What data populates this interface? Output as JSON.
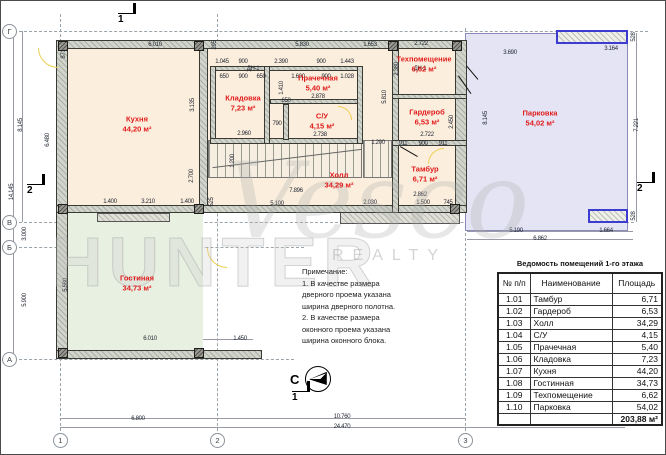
{
  "watermark": {
    "script": "Vesco",
    "caps": "REALTY",
    "outline": "HUNTER"
  },
  "plan": {
    "compass_label": "С",
    "rooms": [
      {
        "name": "Кухня",
        "area": "44,20 м²",
        "x": 137,
        "y": 124
      },
      {
        "name": "Кладовка",
        "area": "7,23 м²",
        "x": 243,
        "y": 103
      },
      {
        "name": "Прачечная",
        "area": "5,40 м²",
        "x": 318,
        "y": 83
      },
      {
        "name": "С/У",
        "area": "4,15 м²",
        "x": 322,
        "y": 121
      },
      {
        "name": "Гардероб",
        "area": "6,53 м²",
        "x": 427,
        "y": 117
      },
      {
        "name": "Техпомещение",
        "area": "6,62 м²",
        "x": 424,
        "y": 64
      },
      {
        "name": "Тамбур",
        "area": "6,71 м²",
        "x": 425,
        "y": 174
      },
      {
        "name": "Холл",
        "area": "34,29 м²",
        "x": 339,
        "y": 180
      },
      {
        "name": "Парковка",
        "area": "54,02 м²",
        "x": 540,
        "y": 118
      },
      {
        "name": "Гостиная",
        "area": "34,73 м²",
        "x": 137,
        "y": 283
      }
    ],
    "axis_bubbles_left": [
      {
        "label": "Г",
        "y": 31
      },
      {
        "label": "В",
        "y": 222
      },
      {
        "label": "Б",
        "y": 247
      },
      {
        "label": "А",
        "y": 359
      }
    ],
    "axis_bubbles_bottom": [
      {
        "label": "1",
        "x": 60
      },
      {
        "label": "2",
        "x": 217
      },
      {
        "label": "3",
        "x": 465
      }
    ],
    "section_markers": [
      {
        "label": "1",
        "x": 118,
        "y": 3
      },
      {
        "label": "1",
        "x": 292,
        "y": 381
      },
      {
        "label": "2",
        "x": 27,
        "y": 174
      },
      {
        "label": "2",
        "x": 637,
        "y": 172
      }
    ],
    "dim_labels": [
      {
        "t": "6.010",
        "x": 155,
        "y": 45
      },
      {
        "t": "295",
        "x": 215,
        "y": 45,
        "r": 1
      },
      {
        "t": "5.830",
        "x": 302,
        "y": 45
      },
      {
        "t": "1.653",
        "x": 370,
        "y": 45
      },
      {
        "t": "2.722",
        "x": 421,
        "y": 44
      },
      {
        "t": "3.690",
        "x": 510,
        "y": 53
      },
      {
        "t": "3.164",
        "x": 611,
        "y": 49
      },
      {
        "t": "528",
        "x": 634,
        "y": 37,
        "r": 1
      },
      {
        "t": "528",
        "x": 634,
        "y": 216,
        "r": 1
      },
      {
        "t": "1.045",
        "x": 222,
        "y": 62
      },
      {
        "t": "900",
        "x": 243,
        "y": 62
      },
      {
        "t": "2.390",
        "x": 281,
        "y": 62
      },
      {
        "t": "900",
        "x": 321,
        "y": 62
      },
      {
        "t": "1.443",
        "x": 347,
        "y": 62
      },
      {
        "t": "ДН-1",
        "x": 253,
        "y": 69
      },
      {
        "t": "ДН-1",
        "x": 420,
        "y": 69
      },
      {
        "t": "650",
        "x": 224,
        "y": 77
      },
      {
        "t": "900",
        "x": 243,
        "y": 77
      },
      {
        "t": "650",
        "x": 261,
        "y": 77
      },
      {
        "t": "1.600",
        "x": 298,
        "y": 77
      },
      {
        "t": "900",
        "x": 326,
        "y": 77
      },
      {
        "t": "1.028",
        "x": 347,
        "y": 77
      },
      {
        "t": "871",
        "x": 64,
        "y": 54,
        "r": 1
      },
      {
        "t": "8.145",
        "x": 21,
        "y": 125,
        "r": 1
      },
      {
        "t": "14.145",
        "x": 12,
        "y": 192,
        "r": 1
      },
      {
        "t": "6.480",
        "x": 48,
        "y": 140,
        "r": 1
      },
      {
        "t": "3.000",
        "x": 25,
        "y": 234,
        "r": 1
      },
      {
        "t": "5.900",
        "x": 25,
        "y": 300,
        "r": 1
      },
      {
        "t": "5.580",
        "x": 66,
        "y": 285,
        "r": 1
      },
      {
        "t": "3.135",
        "x": 193,
        "y": 105,
        "r": 1
      },
      {
        "t": "2.700",
        "x": 192,
        "y": 176,
        "r": 1
      },
      {
        "t": "1.400",
        "x": 110,
        "y": 202
      },
      {
        "t": "3.210",
        "x": 148,
        "y": 202
      },
      {
        "t": "1.400",
        "x": 187,
        "y": 202
      },
      {
        "t": "525",
        "x": 212,
        "y": 202,
        "r": 1
      },
      {
        "t": "1.410",
        "x": 282,
        "y": 88,
        "r": 1
      },
      {
        "t": "650",
        "x": 286,
        "y": 101
      },
      {
        "t": "790",
        "x": 277,
        "y": 124
      },
      {
        "t": "2.960",
        "x": 244,
        "y": 134
      },
      {
        "t": "2.878",
        "x": 318,
        "y": 97
      },
      {
        "t": "2.738",
        "x": 320,
        "y": 135
      },
      {
        "t": "1.200",
        "x": 233,
        "y": 161,
        "r": 1
      },
      {
        "t": "7.896",
        "x": 296,
        "y": 191
      },
      {
        "t": "5.100",
        "x": 277,
        "y": 204
      },
      {
        "t": "2.030",
        "x": 370,
        "y": 203
      },
      {
        "t": "2.862",
        "x": 420,
        "y": 195
      },
      {
        "t": "1.500",
        "x": 423,
        "y": 203
      },
      {
        "t": "745",
        "x": 448,
        "y": 203
      },
      {
        "t": "1.200",
        "x": 378,
        "y": 143
      },
      {
        "t": "911",
        "x": 403,
        "y": 144
      },
      {
        "t": "900",
        "x": 423,
        "y": 144
      },
      {
        "t": "911",
        "x": 443,
        "y": 144
      },
      {
        "t": "2.380",
        "x": 397,
        "y": 69,
        "r": 1
      },
      {
        "t": "5.810",
        "x": 385,
        "y": 97,
        "r": 1
      },
      {
        "t": "2.722",
        "x": 427,
        "y": 135
      },
      {
        "t": "2.450",
        "x": 452,
        "y": 122,
        "r": 1
      },
      {
        "t": "8.145",
        "x": 486,
        "y": 118,
        "r": 1
      },
      {
        "t": "7.221",
        "x": 637,
        "y": 125,
        "r": 1
      },
      {
        "t": "5.190",
        "x": 516,
        "y": 231
      },
      {
        "t": "1.664",
        "x": 606,
        "y": 231
      },
      {
        "t": "6.862",
        "x": 540,
        "y": 239
      },
      {
        "t": "6.010",
        "x": 150,
        "y": 339
      },
      {
        "t": "1.450",
        "x": 240,
        "y": 339
      },
      {
        "t": "6.800",
        "x": 138,
        "y": 419
      },
      {
        "t": "10.760",
        "x": 342,
        "y": 417
      },
      {
        "t": "24.470",
        "x": 342,
        "y": 427
      }
    ]
  },
  "notes": {
    "lines": [
      "Примечание:",
      "1. В качестве размера",
      "дверного проема указана",
      "ширина дверного полотна.",
      "2. В качестве размера",
      "оконного проема указана",
      "ширина оконного блока."
    ]
  },
  "table": {
    "title": "Ведомость помещений 1-го этажа",
    "columns": [
      "№ п/п",
      "Наименование",
      "Площадь"
    ],
    "rows": [
      [
        "1.01",
        "Тамбур",
        "6,71"
      ],
      [
        "1.02",
        "Гардероб",
        "6,53"
      ],
      [
        "1.03",
        "Холл",
        "34,29"
      ],
      [
        "1.04",
        "С/У",
        "4,15"
      ],
      [
        "1.05",
        "Прачечная",
        "5,40"
      ],
      [
        "1.06",
        "Кладовка",
        "7,23"
      ],
      [
        "1.07",
        "Кухня",
        "44,20"
      ],
      [
        "1.08",
        "Гостинная",
        "34,73"
      ],
      [
        "1.09",
        "Техпомещение",
        "6,62"
      ],
      [
        "1.10",
        "Парковка",
        "54,02"
      ]
    ],
    "total": "203,88 м²"
  }
}
